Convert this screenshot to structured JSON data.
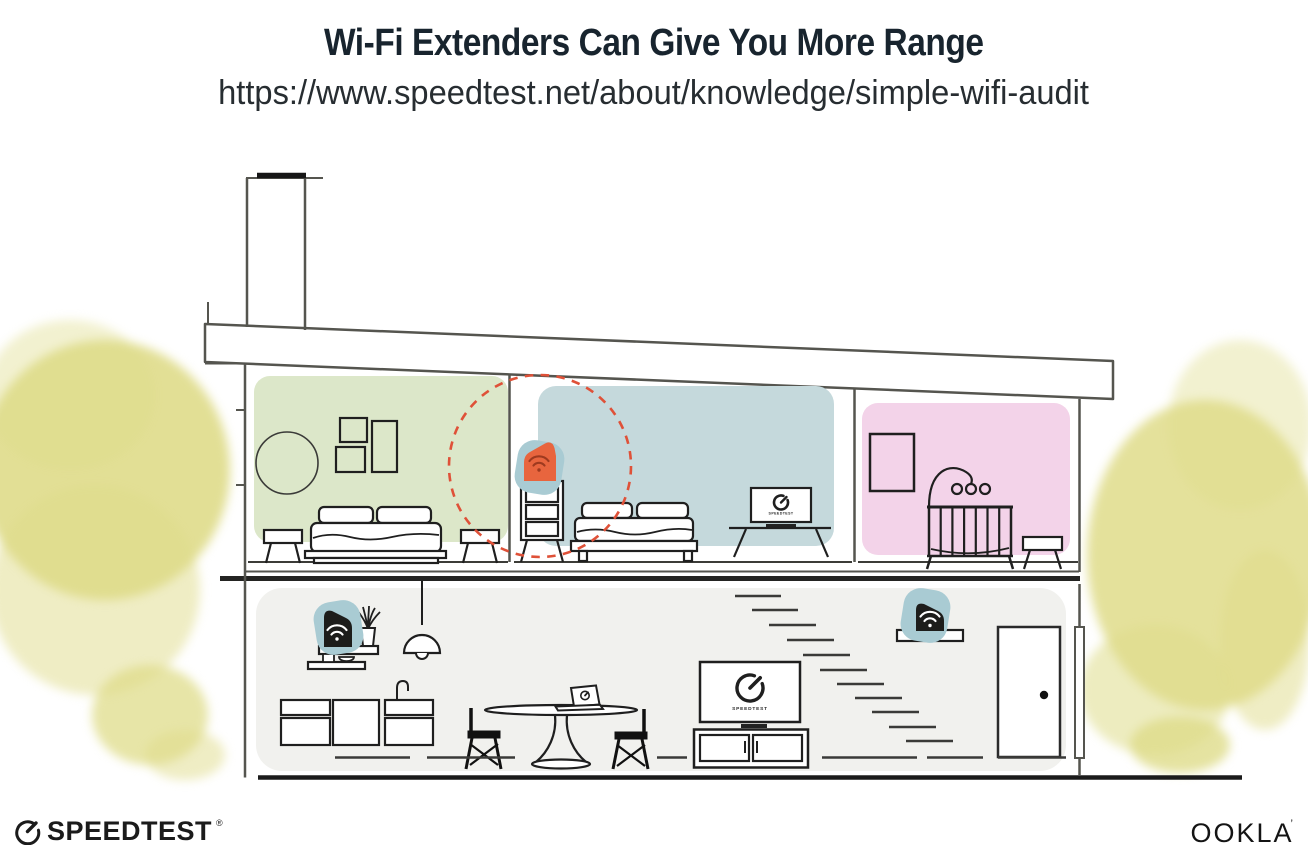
{
  "header": {
    "title": "Wi-Fi Extenders Can Give You More Range",
    "url": "https://www.speedtest.net/about/knowledge/simple-wifi-audit"
  },
  "footer": {
    "speedtest_wordmark": "SPEEDTEST",
    "speedtest_registered_mark": "®",
    "ookla_wordmark": "OOKLA",
    "ookla_trademark": "’"
  },
  "illustration": {
    "scene": "Cutaway of a two-story house showing a Wi-Fi router and extenders with a dashed coverage circle",
    "screens": {
      "upstairs_tv": {
        "label": "SPEEDTEST"
      },
      "downstairs_tv": {
        "label": "SPEEDTEST"
      }
    },
    "devices": [
      {
        "name": "wifi-router",
        "location": "downstairs wall shelf above kitchen",
        "body": "#1d1d1b"
      },
      {
        "name": "wifi-extender",
        "location": "upstairs middle bedroom dresser",
        "body": "#e8653e"
      },
      {
        "name": "wifi-extender",
        "location": "downstairs shelf beside stairs",
        "body": "#1d1d1b"
      }
    ],
    "colors": {
      "bedroom_left_bg": "#dce7c9",
      "bedroom_middle_bg": "#c5d9dc",
      "nursery_bg": "#f3d3e9",
      "downstairs_bg": "#f1f1ee",
      "device_halo": "#a9cbd3",
      "extender_body": "#e8653e",
      "extender_wifi": "#9e3a1f",
      "range_circle": "#df5138",
      "foliage": "#dfdc8a",
      "wall_line": "#55554f",
      "furniture_line": "#1f1f1f",
      "ground_line": "#1b1b1b"
    }
  }
}
